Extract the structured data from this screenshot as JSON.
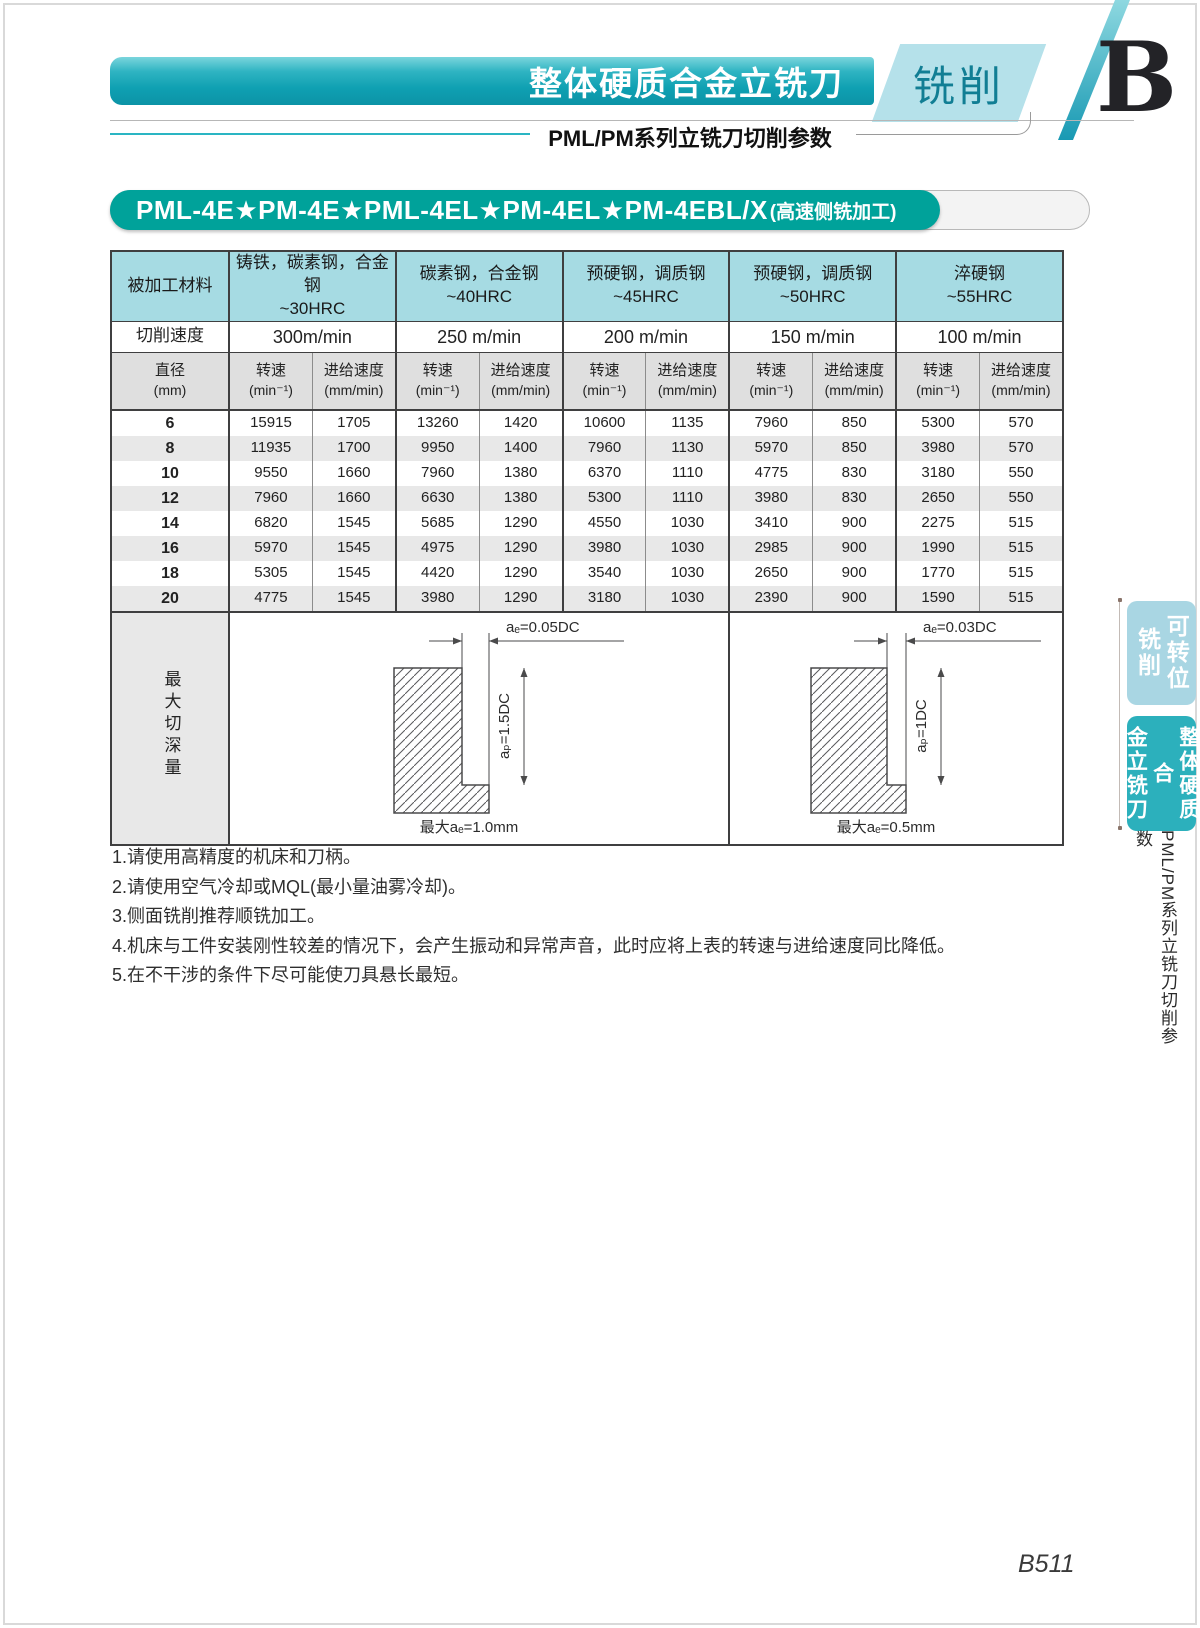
{
  "header": {
    "main_title": "整体硬质合金立铣刀",
    "category": "铣削",
    "section_letter": "B",
    "subtitle": "PML/PM系列立铣刀切削参数"
  },
  "banner": {
    "models": "PML-4E★PM-4E★PML-4EL★PM-4EL★PM-4EBL/X",
    "suffix": "(高速侧铣加工)"
  },
  "table": {
    "material_header": "被加工材料",
    "cutting_speed_header": "切削速度",
    "diameter_header": "直径",
    "diameter_unit": "(mm)",
    "speed_col": "转速",
    "speed_col_unit": "(min⁻¹)",
    "feed_col": "进给速度",
    "feed_col_unit": "(mm/min)",
    "groups": [
      {
        "material": "铸铁，碳素钢，合金钢",
        "hardness": "~30HRC",
        "cutting_speed": "300m/min"
      },
      {
        "material": "碳素钢，合金钢",
        "hardness": "~40HRC",
        "cutting_speed": "250 m/min"
      },
      {
        "material": "预硬钢，调质钢",
        "hardness": "~45HRC",
        "cutting_speed": "200 m/min"
      },
      {
        "material": "预硬钢，调质钢",
        "hardness": "~50HRC",
        "cutting_speed": "150 m/min"
      },
      {
        "material": "淬硬钢",
        "hardness": "~55HRC",
        "cutting_speed": "100 m/min"
      }
    ],
    "rows": [
      {
        "diameter": "6",
        "values": [
          "15915",
          "1705",
          "13260",
          "1420",
          "10600",
          "1135",
          "7960",
          "850",
          "5300",
          "570"
        ]
      },
      {
        "diameter": "8",
        "values": [
          "11935",
          "1700",
          "9950",
          "1400",
          "7960",
          "1130",
          "5970",
          "850",
          "3980",
          "570"
        ]
      },
      {
        "diameter": "10",
        "values": [
          "9550",
          "1660",
          "7960",
          "1380",
          "6370",
          "1110",
          "4775",
          "830",
          "3180",
          "550"
        ]
      },
      {
        "diameter": "12",
        "values": [
          "7960",
          "1660",
          "6630",
          "1380",
          "5300",
          "1110",
          "3980",
          "830",
          "2650",
          "550"
        ]
      },
      {
        "diameter": "14",
        "values": [
          "6820",
          "1545",
          "5685",
          "1290",
          "4550",
          "1030",
          "3410",
          "900",
          "2275",
          "515"
        ]
      },
      {
        "diameter": "16",
        "values": [
          "5970",
          "1545",
          "4975",
          "1290",
          "3980",
          "1030",
          "2985",
          "900",
          "1990",
          "515"
        ]
      },
      {
        "diameter": "18",
        "values": [
          "5305",
          "1545",
          "4420",
          "1290",
          "3540",
          "1030",
          "2650",
          "900",
          "1770",
          "515"
        ]
      },
      {
        "diameter": "20",
        "values": [
          "4775",
          "1545",
          "3980",
          "1290",
          "3180",
          "1030",
          "2390",
          "900",
          "1590",
          "515"
        ]
      }
    ],
    "max_depth_label": "最大切深量",
    "diagrams": [
      {
        "ae_label": "aₑ=0.05DC",
        "ap_label": "aₚ=1.5DC",
        "max_label": "最大aₑ=1.0mm"
      },
      {
        "ae_label": "aₑ=0.03DC",
        "ap_label": "aₚ=1DC",
        "max_label": "最大aₑ=0.5mm"
      }
    ]
  },
  "notes": [
    "1.请使用高精度的机床和刀柄。",
    "2.请使用空气冷却或MQL(最小量油雾冷却)。",
    "3.侧面铣削推荐顺铣加工。",
    "4.机床与工件安装刚性较差的情况下，会产生振动和异常声音，此时应将上表的转速与进给速度同比降低。",
    "5.在不干涉的条件下尽可能使刀具悬长最短。"
  ],
  "side_tabs": [
    {
      "line1": "可转位",
      "line2": "铣削"
    },
    {
      "line1": "整体硬质合",
      "line2": "金立铣刀"
    }
  ],
  "side_caption": "PML/PM系列立铣刀切削参数",
  "page_number": "B511",
  "colors": {
    "banner_teal": "#00a29a",
    "table_header_teal": "#a6dbe3",
    "row_alt_gray": "#e8e8e8",
    "tab_light": "#a9d6e3",
    "tab_dark": "#2cb0bc"
  }
}
